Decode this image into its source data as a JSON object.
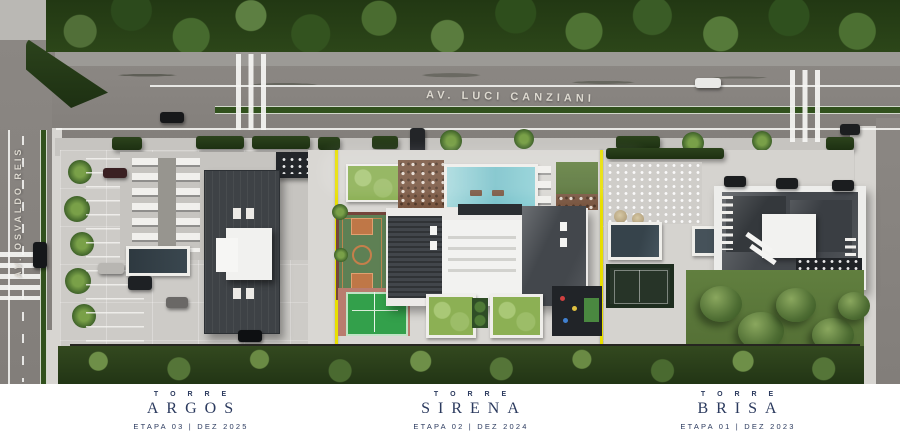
{
  "streets": {
    "horizontal": "AV. LUCI CANZIANI",
    "vertical": "AV. OSVALDO REIS"
  },
  "towers": [
    {
      "kicker": "T O R R E",
      "name": "ARGOS",
      "stage": "ETAPA 03 | DEZ 2025"
    },
    {
      "kicker": "T O R R E",
      "name": "SIRENA",
      "stage": "ETAPA 02 | DEZ 2024"
    },
    {
      "kicker": "T O R R E",
      "name": "BRISA",
      "stage": "ETAPA 01 | DEZ 2023"
    }
  ],
  "colors": {
    "label_navy": "#2b3a5e",
    "boundary_yellow": "#e8df00",
    "road_gray": "#8b8783",
    "lot_gray": "#cdcbc7",
    "pool_blue": "#8ccdd3",
    "dark_pool": "#36434b",
    "lawn_green": "#5d7c3c",
    "canopy_green": "#2c4619",
    "court_orange": "#c57f4b",
    "tennis_green": "#33a04b"
  }
}
